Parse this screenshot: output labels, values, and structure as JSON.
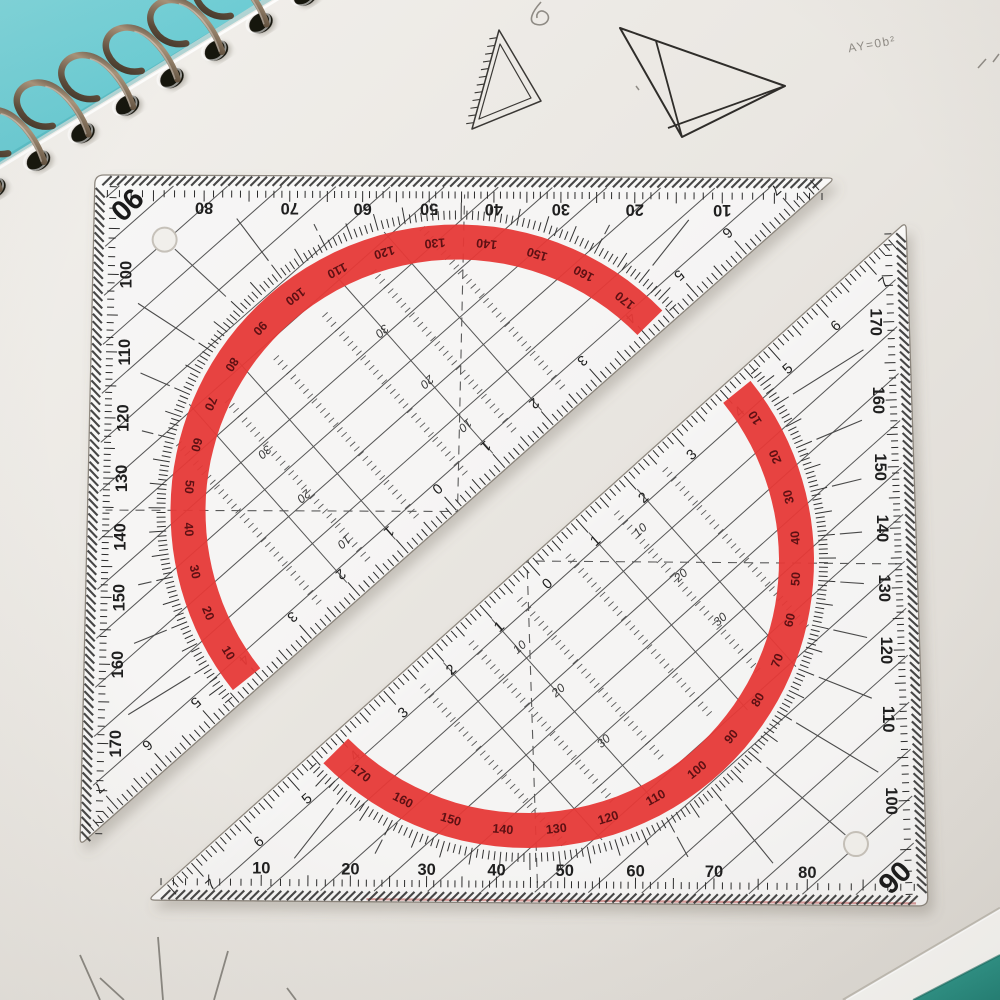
{
  "scene": {
    "width": 1000,
    "height": 1000,
    "colors": {
      "paper_light": "#f2f0ec",
      "paper_mid": "#e9e6e1",
      "paper_dark": "#dbd7d1",
      "desk_teal_top_left": "#74ced6",
      "desk_teal_bottom_right": "#2b958a",
      "white_sheet": "#f6f5f2",
      "wire_dark": "#3a2f26",
      "wire_light": "#a8937a",
      "hole_black": "#17120e",
      "pencil": "#8f8b85",
      "sketch_ink": "#3a3835",
      "ruler_body": "rgba(255,255,255,0.78)",
      "ruler_outline": "rgba(125,118,108,0.85)",
      "ruler_red": "#e63937",
      "red_number": "#5d1013",
      "tick_black": "#2b2b2b",
      "guide_gray": "#555555"
    }
  },
  "desk": {
    "top_left_polygon": [
      [
        0,
        0
      ],
      [
        262,
        0
      ],
      [
        0,
        162
      ]
    ],
    "bottom_right_teal_polygon": [
      [
        913,
        1000
      ],
      [
        1000,
        1000
      ],
      [
        1000,
        955
      ]
    ],
    "white_sheet_polygon": [
      [
        843,
        1000
      ],
      [
        913,
        1000
      ],
      [
        1000,
        955
      ],
      [
        1000,
        908
      ]
    ]
  },
  "notebook": {
    "coil_count": 9,
    "coil_start": [
      -6,
      188
    ],
    "coil_step": [
      44.5,
      -27.5
    ],
    "coil_angle_deg": -31.7,
    "page_edge": [
      [
        -35,
        183
      ],
      [
        320,
        -32
      ]
    ]
  },
  "sketches": {
    "small_triangle": {
      "outer": [
        [
          499,
          30
        ],
        [
          472,
          129
        ],
        [
          541,
          101
        ]
      ],
      "inner": [
        [
          500,
          44
        ],
        [
          479,
          119
        ],
        [
          531,
          98
        ]
      ],
      "hatch_edge": [
        0,
        1
      ]
    },
    "large_triangle": {
      "points": [
        [
          620,
          28
        ],
        [
          785,
          86
        ],
        [
          682,
          137
        ]
      ],
      "cevians": [
        [
          [
            656,
            41
          ],
          [
            682,
            137
          ]
        ],
        [
          [
            785,
            86
          ],
          [
            668,
            128
          ]
        ]
      ]
    },
    "formula": {
      "text": "AY=0b²",
      "x": 872,
      "y": 44,
      "rotate": -10,
      "size": 12
    },
    "pencil_marks": [
      [
        [
          978,
          68
        ],
        [
          986,
          59
        ]
      ],
      [
        [
          993,
          62
        ],
        [
          999,
          54
        ]
      ],
      [
        [
          636,
          86
        ],
        [
          639,
          90
        ]
      ]
    ],
    "squiggle": "M 541 2 C 532 12 528 21 535 24 C 546 28 553 17 545 12 C 540 9 536 13 537 18",
    "fan_lines": [
      [
        [
          100,
          1000
        ],
        [
          80,
          955
        ]
      ],
      [
        [
          124,
          1000
        ],
        [
          100,
          978
        ]
      ],
      [
        [
          163,
          1000
        ],
        [
          158,
          937
        ]
      ],
      [
        [
          214,
          1000
        ],
        [
          228,
          951
        ]
      ],
      [
        [
          296,
          1000
        ],
        [
          287,
          988
        ]
      ]
    ]
  },
  "ruler_design": {
    "cm_px": 64.5,
    "red_band": {
      "inner_r": 252,
      "outer_r": 287,
      "number_r": 269
    },
    "arc_r": 292,
    "red_numbers": [
      10,
      20,
      30,
      40,
      50,
      60,
      70,
      80,
      90,
      100,
      110,
      120,
      130,
      140,
      150,
      160,
      170
    ],
    "leg1_numbers": [
      10,
      20,
      30,
      40,
      50,
      60,
      70,
      80
    ],
    "corner_label": "90",
    "leg2_numbers": [
      100,
      110,
      120,
      130,
      140,
      150,
      160,
      170
    ],
    "cm_numbers": [
      1,
      2,
      3,
      4,
      5,
      6,
      7
    ],
    "center_label": "0",
    "offset_label_rails": [
      {
        "t": 105,
        "entries": [
          {
            "n": 52,
            "label": "10"
          },
          {
            "n": 113,
            "label": "20"
          },
          {
            "n": 172,
            "label": "30"
          }
        ]
      },
      {
        "t": -63,
        "entries": [
          {
            "n": 59,
            "label": "10"
          },
          {
            "n": 117,
            "label": "20"
          },
          {
            "n": 185,
            "label": "30"
          }
        ]
      }
    ],
    "hatch_spacing": 36,
    "hatch_count": 13
  },
  "rulers": [
    {
      "name": "set-square-top-left",
      "Hb": [
        835,
        178
      ],
      "A": [
        95,
        175
      ],
      "Ht": [
        80,
        845
      ],
      "flip": 180,
      "red_edge": false
    },
    {
      "name": "set-square-bottom-right",
      "Hb": [
        148,
        900
      ],
      "A": [
        928,
        906
      ],
      "Ht": [
        906,
        222
      ],
      "flip": 0,
      "red_edge": true
    }
  ]
}
